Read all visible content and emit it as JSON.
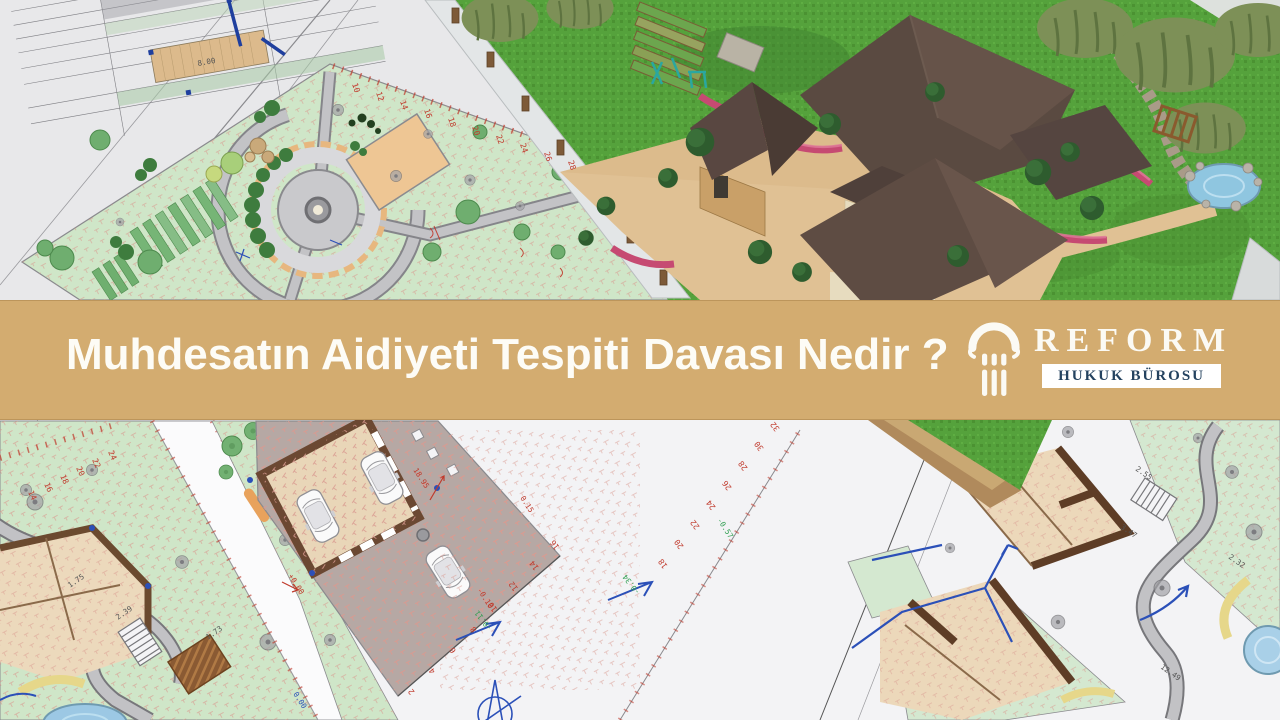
{
  "banner": {
    "title": "Muhdesatın Aidiyeti Tespiti Davası Nedir ?"
  },
  "logo": {
    "name": "REFORM",
    "subtitle": "HUKUK BÜROSU",
    "icon": "column-icon"
  },
  "colors": {
    "banner": "#d3ac70",
    "title": "#fdfcf6",
    "logo_text": "#fbfaf4",
    "logo_subtitle": "#24425f",
    "subtitle_bg": "#ffffff",
    "plan_lawn": "#cfe6c8",
    "render_grass": "#55a23c",
    "roof": "#5b4a41",
    "paving": "#e0c194",
    "dim_red": "#c0392b",
    "dim_blue": "#2b50b8"
  },
  "annotations": {
    "dims": [
      "8.00",
      "18.95",
      "+0.00",
      "-0.10",
      "0.15",
      "0.00",
      "-0.57",
      "2.55",
      "2.32",
      "3.47",
      "1.75",
      "12.49",
      "1.73",
      "2.39",
      "-0.11",
      "-0.34"
    ],
    "scale_plot_edge": [
      "10",
      "12",
      "14",
      "16",
      "18",
      "20",
      "22",
      "24",
      "26",
      "28"
    ],
    "scale_parking_edge": [
      "2",
      "4",
      "6",
      "8",
      "10",
      "12",
      "14",
      "16"
    ],
    "scale_right_plan": [
      "18",
      "20",
      "22",
      "24",
      "26",
      "28",
      "30",
      "32"
    ],
    "scale_left_road": [
      "14",
      "16",
      "18",
      "20",
      "22",
      "24"
    ]
  }
}
